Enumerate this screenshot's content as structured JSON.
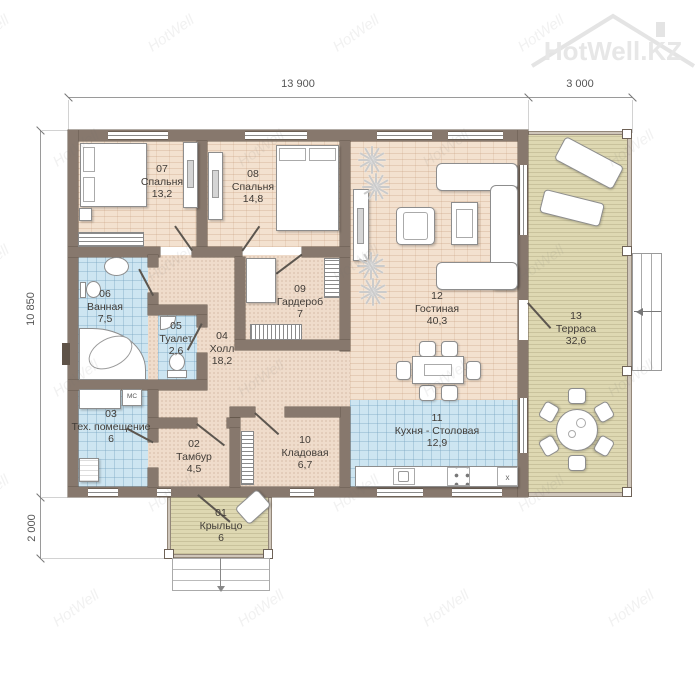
{
  "brand": {
    "logo_text": "HotWell.KZ",
    "watermark_text": "HotWell"
  },
  "dimensions": {
    "top_main": "13 900",
    "top_terrace": "3 000",
    "left_main": "10 850",
    "left_porch": "2 000"
  },
  "rooms": {
    "r01": {
      "num": "01",
      "name": "Крыльцо",
      "area": "6"
    },
    "r02": {
      "num": "02",
      "name": "Тамбур",
      "area": "4,5"
    },
    "r03": {
      "num": "03",
      "name": "Тех. помещение",
      "area": "6"
    },
    "r04": {
      "num": "04",
      "name": "Холл",
      "area": "18,2"
    },
    "r05": {
      "num": "05",
      "name": "Туалет",
      "area": "2,6"
    },
    "r06": {
      "num": "06",
      "name": "Ванная",
      "area": "7,5"
    },
    "r07": {
      "num": "07",
      "name": "Спальня",
      "area": "13,2"
    },
    "r08": {
      "num": "08",
      "name": "Спальня",
      "area": "14,8"
    },
    "r09": {
      "num": "09",
      "name": "Гардероб",
      "area": "7"
    },
    "r10": {
      "num": "10",
      "name": "Кладовая",
      "area": "6,7"
    },
    "r11": {
      "num": "11",
      "name": "Кухня - Столовая",
      "area": "12,9"
    },
    "r12": {
      "num": "12",
      "name": "Гостиная",
      "area": "40,3"
    },
    "r13": {
      "num": "13",
      "name": "Терраса",
      "area": "32,6"
    }
  },
  "labels": {
    "washing_machine": "МС",
    "fridge": "x"
  }
}
